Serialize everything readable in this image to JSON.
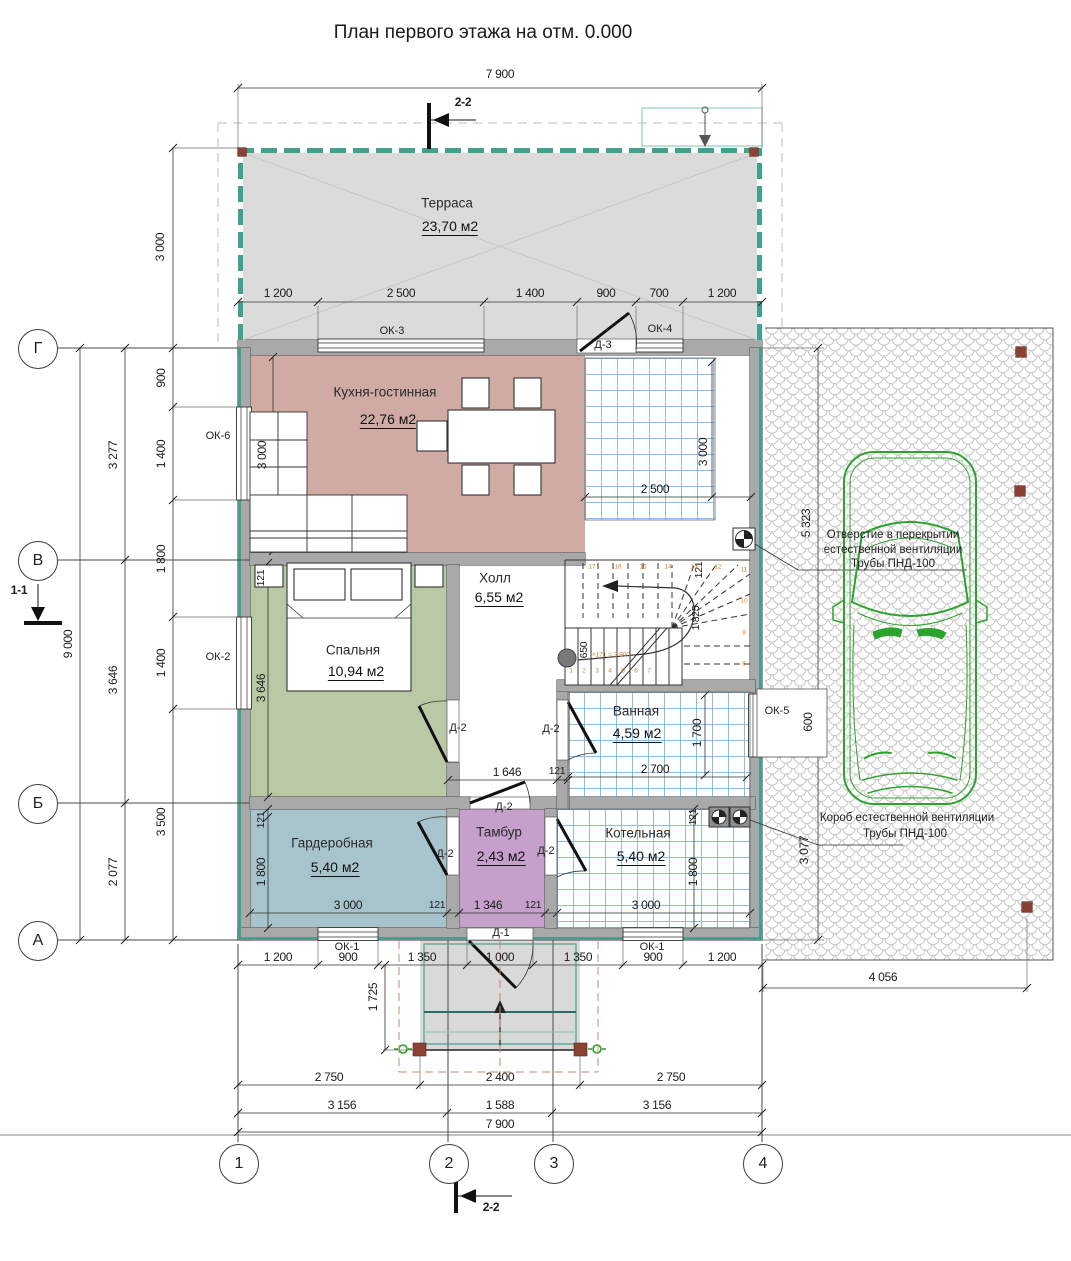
{
  "title": "План первого этажа на отм. 0.000",
  "axes": {
    "h": [
      "Г",
      "В",
      "Б",
      "А"
    ],
    "v": [
      "1",
      "2",
      "3",
      "4"
    ]
  },
  "section_marks": {
    "top": "2-2",
    "bottom": "2-2",
    "left": "1-1"
  },
  "rooms": {
    "terrace": {
      "name": "Терраса",
      "area": "23,70 м2"
    },
    "kitchen": {
      "name": "Кухня-гостинная",
      "area": "22,76 м2"
    },
    "hall": {
      "name": "Холл",
      "area": "6,55 м2"
    },
    "bedroom": {
      "name": "Спальня",
      "area": "10,94 м2"
    },
    "bath": {
      "name": "Ванная",
      "area": "4,59 м2"
    },
    "wardrobe": {
      "name": "Гардеробная",
      "area": "5,40 м2"
    },
    "tambour": {
      "name": "Тамбур",
      "area": "2,43 м2"
    },
    "boiler": {
      "name": "Котельная",
      "area": "5,40 м2"
    }
  },
  "openings": {
    "ok1a": "ОК-1",
    "ok1b": "ОК-1",
    "ok2": "ОК-2",
    "ok3": "ОК-3",
    "ok4": "ОК-4",
    "ok5": "ОК-5",
    "ok6": "ОК-6",
    "d1": "Д-1",
    "d2_bed": "Д-2",
    "d2_hall": "Д-2",
    "d2_bath": "Д-2",
    "d2_tl": "Д-2",
    "d2_tr": "Д-2",
    "d3": "Д-3"
  },
  "dims": {
    "t7900": "7 900",
    "trow": [
      "1 200",
      "2 500",
      "1 400",
      "900",
      "700",
      "1 200"
    ],
    "th3000": "3 000",
    "l9000": "9 000",
    "lax": [
      "3 277",
      "3 646",
      "2 077"
    ],
    "lwall": [
      "900",
      "1 400",
      "1 800",
      "1 400",
      "3 500"
    ],
    "kit3000": "3 000",
    "ent2500": "2 500",
    "ent3000": "3 000",
    "hall1646": "1 646",
    "hall121": "121",
    "bed121": "121",
    "bed3646": "3 646",
    "bath2700": "2 700",
    "bath1700": "1 700",
    "ok5h": "600",
    "ward121": "121",
    "ward1800": "1 800",
    "brow": [
      "3 000",
      "121",
      "1 346",
      "121",
      "3 000"
    ],
    "boil121": "121",
    "boil1800": "1 800",
    "wrow": [
      "1 200",
      "900",
      "1 350",
      "1 000",
      "1 350",
      "900",
      "1 200"
    ],
    "porch1725": "1 725",
    "r275": [
      "2 750",
      "2 400",
      "2 750"
    ],
    "r315": [
      "3 156",
      "1 588",
      "3 156"
    ],
    "b7900": "7 900",
    "rv": [
      "5 323",
      "3 077"
    ],
    "rb": "4 056",
    "st650": "650",
    "st121": "121",
    "st1825": "1 825"
  },
  "stairs": {
    "numbers": [
      "1",
      "2",
      "3",
      "4",
      "5",
      "6",
      "7",
      "8",
      "9",
      "10",
      "11",
      "12",
      "13",
      "14",
      "15",
      "16",
      "17"
    ],
    "note": "×171 = 2 900"
  },
  "annotations": {
    "vent_hole": [
      "Отверстие в перекрытии",
      "естественной вентиляции",
      "Трубы ПНД-100"
    ],
    "vent_duct": [
      "Короб естественной вентиляции",
      "Трубы ПНД-100"
    ]
  },
  "colors": {
    "wall_teal": "#42a18d",
    "kitchen": "#cfaba4",
    "bedroom": "#b9c8a5",
    "wardrobe": "#a7c4cc",
    "tambour": "#c4a0cb",
    "terrace": "#dbdbdb",
    "tile_line": "#8abce6",
    "car": "#2ca32c",
    "stair_num": "#d4822a",
    "marker_brown": "#8b4134",
    "porch_dash": "#c08878"
  }
}
